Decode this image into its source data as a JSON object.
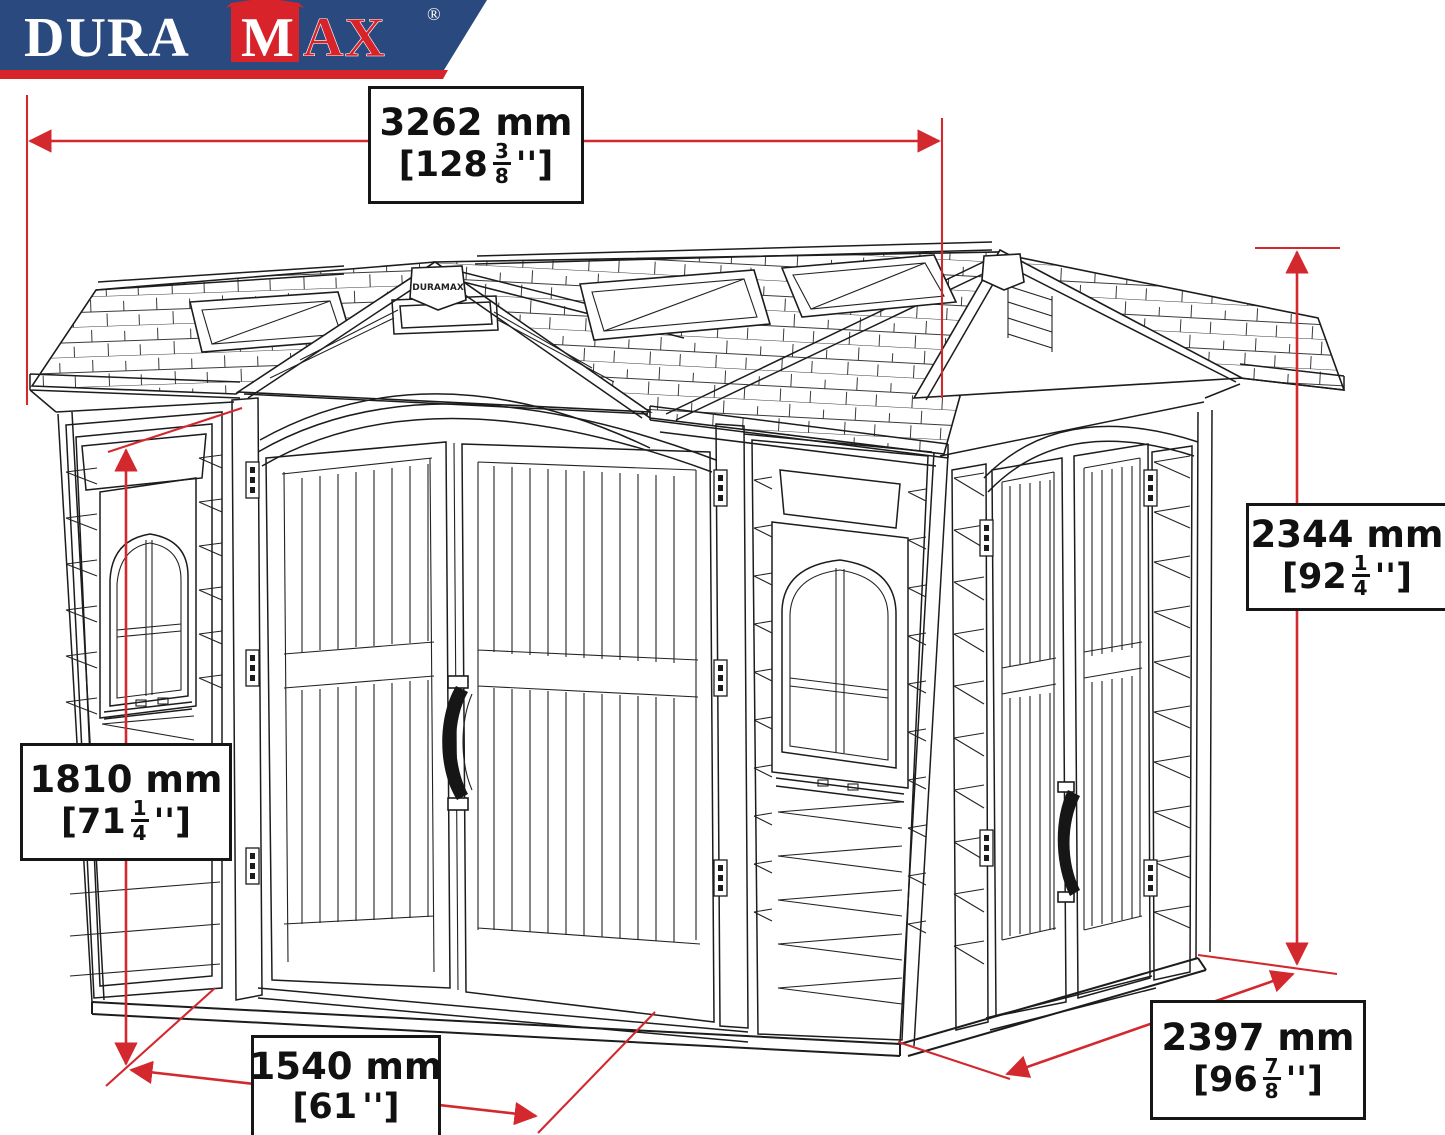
{
  "page": {
    "background": "#ffffff"
  },
  "brand": {
    "logo": {
      "dura": "DURA",
      "m": "M",
      "ax": "AX",
      "registered": "®",
      "banner_color": "#2a4a7f",
      "accent_red": "#d8232a",
      "text_white": "#ffffff"
    },
    "gable_plate_text": "DURAMAX"
  },
  "drawing": {
    "line_color": "#1c1c1c",
    "dimension_color": "#d2282e",
    "subject": "DuraMax vinyl storage shed technical line drawing with dimension callouts"
  },
  "dimensions": {
    "width_overall": {
      "mm": "3262 mm",
      "inch_prefix": "[128",
      "frac_num": "3",
      "frac_den": "8",
      "inch_suffix": "'']"
    },
    "height_overall": {
      "mm": "2344 mm",
      "inch_prefix": "[92",
      "frac_num": "1",
      "frac_den": "4",
      "inch_suffix": "'']"
    },
    "height_door": {
      "mm": "1810 mm",
      "inch_prefix": "[71",
      "frac_num": "1",
      "frac_den": "4",
      "inch_suffix": "'']"
    },
    "width_door": {
      "mm": "1540 mm",
      "inch_prefix": "[61",
      "frac_num": "",
      "frac_den": "",
      "inch_suffix": "'']"
    },
    "depth_overall": {
      "mm": "2397 mm",
      "inch_prefix": "[96",
      "frac_num": "7",
      "frac_den": "8",
      "inch_suffix": "'']"
    }
  }
}
